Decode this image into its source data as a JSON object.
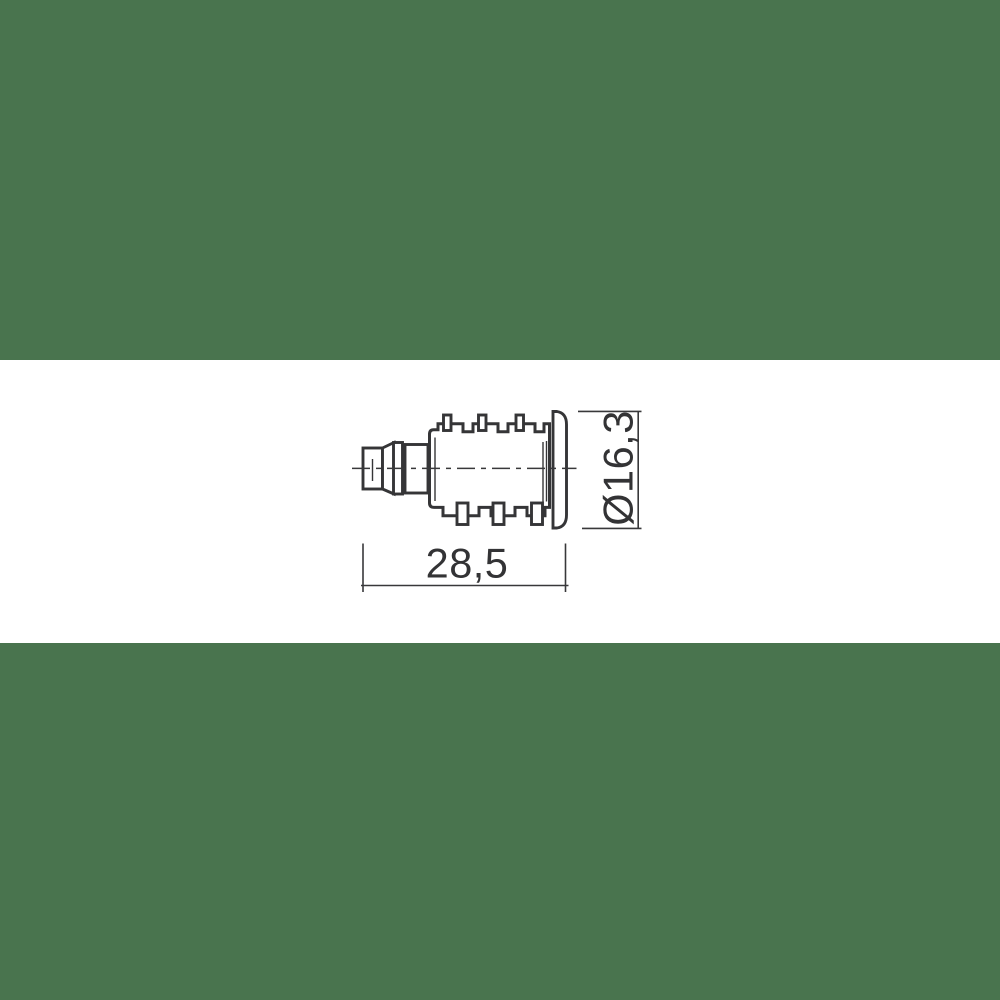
{
  "theme": {
    "band_color": "#49744E",
    "canvas_color": "#FFFFFF",
    "line_color": "#353537",
    "text_color": "#333335"
  },
  "drawing": {
    "length_dimension_label": "28,5",
    "diameter_dimension_label": "Ø16,3"
  }
}
